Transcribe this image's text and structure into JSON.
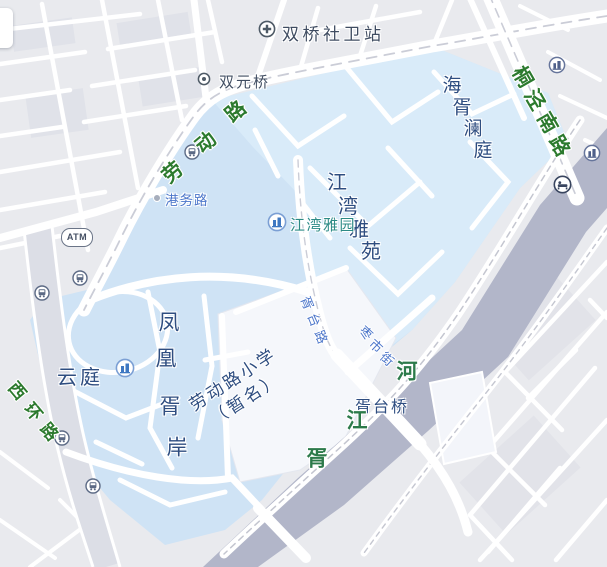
{
  "map": {
    "colors": {
      "background": "#e9eaee",
      "highlight_area": "#cfe3f5",
      "highlight_area_light": "#d9ebf9",
      "river": "#b2b6c9",
      "road": "#ffffff",
      "road_label_green": "#2c7a2e",
      "poi_label_navy": "#2e4d80",
      "street_label_blue": "#4c76ca",
      "metro_poi_teal": "#2b8a85",
      "river_label_green": "#2c7a4a"
    },
    "pois": {
      "clinic": {
        "label": "双桥社卫站"
      },
      "shuangyuan_bridge": {
        "label": "双元桥"
      },
      "haixu_lanting": {
        "label": "海胥澜庭"
      },
      "jiangwan_estate": {
        "label": "江湾雅苑"
      },
      "jiangwan_garden": {
        "label": "江湾雅园"
      },
      "fenghuang_xuan": {
        "label": "凤凰胥岸"
      },
      "yunting": {
        "label": "云庭"
      },
      "school": {
        "line1": "劳动路小学",
        "line2": "（暂名）"
      },
      "xutai_bridge": {
        "label": "胥台桥"
      },
      "atm": {
        "label": "ATM"
      }
    },
    "roads": {
      "laodong": "劳动路",
      "tongjing_south": "桐泾南路",
      "xihuan": "西环路",
      "gangwu": "港务路",
      "xutai": "胥台路",
      "zaoshi": "枣市街"
    },
    "river": {
      "name": "胥江河"
    },
    "icons": {
      "clinic_station": "circle-plus",
      "bridge_marker": "circle-dot",
      "bus_stop": "circle-bus",
      "residence_poi": "circle-building-blue",
      "company_poi": "circle-building-gray",
      "hotel_poi": "circle-bed",
      "atm": "pill-text",
      "road_point": "small-dot"
    }
  }
}
